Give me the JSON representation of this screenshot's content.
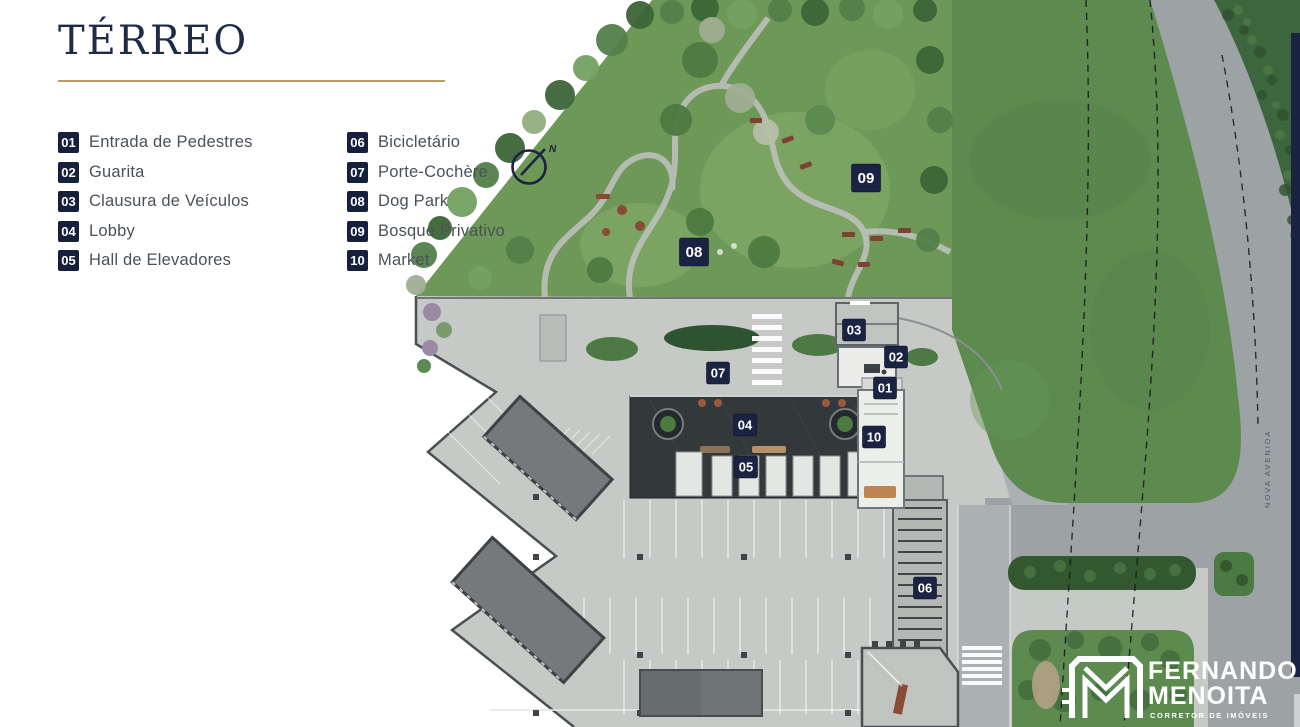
{
  "title": "TÉRREO",
  "colors": {
    "navy": "#1b2342",
    "accent_rule": "#bf9a63",
    "field_green": "#5c8a4f",
    "garden_green": "#6e9857",
    "road_gray": "#9da2a4",
    "plaza_gray": "#c6c9c5"
  },
  "legend": {
    "items": [
      {
        "num": "01",
        "label": "Entrada de Pedestres"
      },
      {
        "num": "02",
        "label": "Guarita"
      },
      {
        "num": "03",
        "label": "Clausura de Veículos"
      },
      {
        "num": "04",
        "label": "Lobby"
      },
      {
        "num": "05",
        "label": "Hall de Elevadores"
      },
      {
        "num": "06",
        "label": "Bicicletário"
      },
      {
        "num": "07",
        "label": "Porte-Cochère"
      },
      {
        "num": "08",
        "label": "Dog Park"
      },
      {
        "num": "09",
        "label": "Bosque Privativo"
      },
      {
        "num": "10",
        "label": "Market"
      }
    ]
  },
  "compass": {
    "north_label": "N"
  },
  "map": {
    "street_label": "NOVA AVENIDA",
    "markers": [
      {
        "label": "01"
      },
      {
        "label": "02"
      },
      {
        "label": "03"
      },
      {
        "label": "04"
      },
      {
        "label": "05"
      },
      {
        "label": "06"
      },
      {
        "label": "07"
      },
      {
        "label": "08"
      },
      {
        "label": "09"
      },
      {
        "label": "10"
      }
    ]
  },
  "logo": {
    "line1": "FERNANDO",
    "line2": "MENOITA",
    "tagline": "CORRETOR DE IMÓVEIS"
  }
}
